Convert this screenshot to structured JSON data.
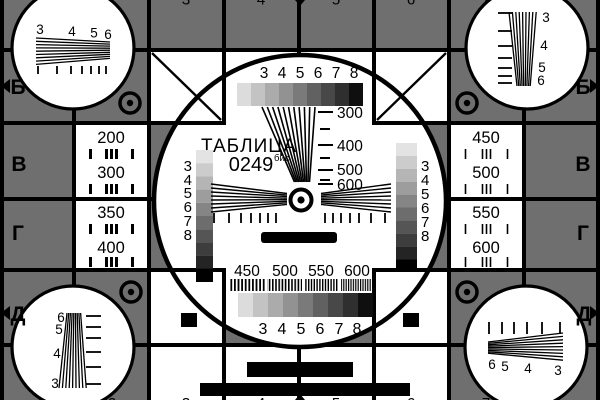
{
  "colors": {
    "background_gray": "#6f6f6f",
    "foreground_black": "#000000",
    "card_white": "#ffffff"
  },
  "title": {
    "name_label": "ТАБЛИЦА",
    "number_label": "0249",
    "number_superscript": "бис"
  },
  "row_markers": {
    "left": [
      "Б",
      "В",
      "Г",
      "Д"
    ],
    "right": [
      "Б",
      "В",
      "Г",
      "Д"
    ]
  },
  "column_markers": {
    "top": [
      "3",
      "4",
      "5",
      "6",
      "7"
    ],
    "bottom": [
      "2",
      "3",
      "4",
      "5",
      "6",
      "7"
    ]
  },
  "side_panels": {
    "left": [
      {
        "top": "200",
        "bottom": "300"
      },
      {
        "top": "350",
        "bottom": "400"
      }
    ],
    "right": [
      {
        "top": "450",
        "bottom": "500"
      },
      {
        "top": "550",
        "bottom": "600"
      }
    ]
  },
  "center_circle": {
    "top_grayscale_labels": [
      "3",
      "4",
      "5",
      "6",
      "7",
      "8"
    ],
    "bottom_grayscale_labels": [
      "3",
      "4",
      "5",
      "6",
      "7",
      "8"
    ],
    "left_strip_labels": [
      "3",
      "4",
      "5",
      "6",
      "7",
      "8"
    ],
    "right_strip_labels": [
      "3",
      "4",
      "5",
      "6",
      "7",
      "8"
    ],
    "resolution_wedge_labels": [
      "300",
      "400",
      "500",
      "600"
    ],
    "frequency_band_labels": [
      "450",
      "500",
      "550",
      "600"
    ]
  },
  "corner_circles": {
    "top_left": [
      "3",
      "4",
      "5",
      "6"
    ],
    "top_right": [
      "3",
      "4",
      "5",
      "6"
    ],
    "bottom_left": [
      "6",
      "5",
      "4",
      "3"
    ],
    "bottom_right": [
      "6",
      "5",
      "4",
      "3"
    ]
  },
  "grayscale": {
    "steps9": [
      "#dcdcdc",
      "#c3c3c3",
      "#ababab",
      "#929292",
      "#7a7a7a",
      "#616161",
      "#484848",
      "#2f2f2f",
      "#0f0f0f"
    ],
    "steps10": [
      "#e3e3e3",
      "#cccccc",
      "#b5b5b5",
      "#9d9d9d",
      "#858585",
      "#6d6d6d",
      "#555555",
      "#3d3d3d",
      "#242424",
      "#000000"
    ]
  }
}
